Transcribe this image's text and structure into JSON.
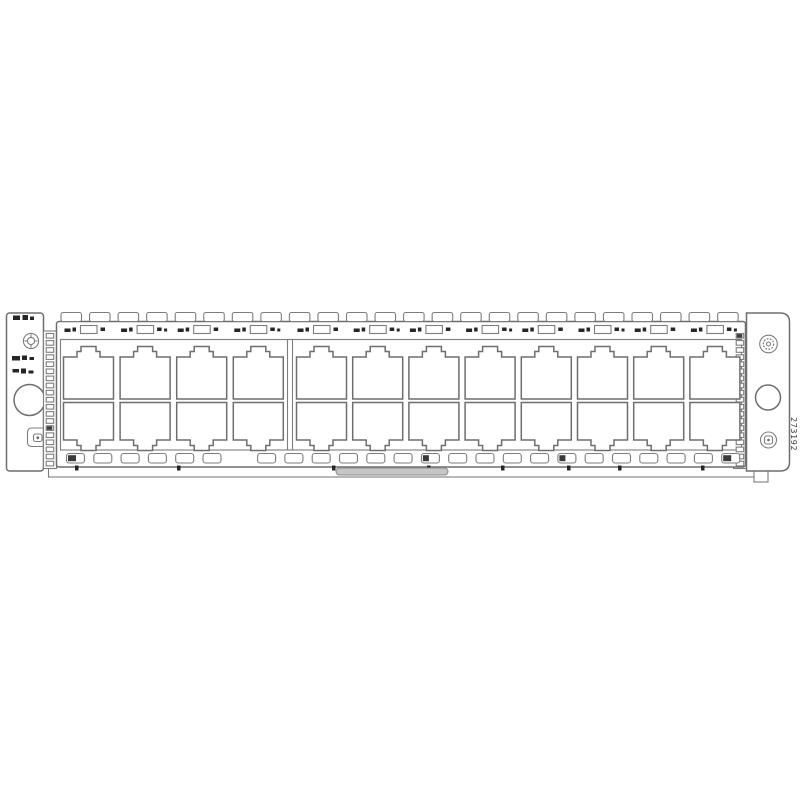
{
  "product": {
    "part_number_label": "273192"
  },
  "faceplate": {
    "port_rows": 2,
    "port_columns": 12,
    "ports_total": 24,
    "port_group_columns": [
      4,
      8
    ],
    "top_tab_count": 24,
    "led_slot_count": 24,
    "led_skip_index": 6,
    "led_dark_indices": [
      0,
      13,
      18,
      24
    ],
    "emi_finger_count": 19,
    "bottom_tick_xs": [
      75,
      177,
      332,
      427,
      501,
      567,
      618,
      701,
      746
    ]
  },
  "colors": {
    "background": "#ffffff",
    "line": "#6e6e6e",
    "line_soft": "#7d7d7d",
    "mark": "#262626",
    "handle_fill": "#c6c6c6"
  }
}
